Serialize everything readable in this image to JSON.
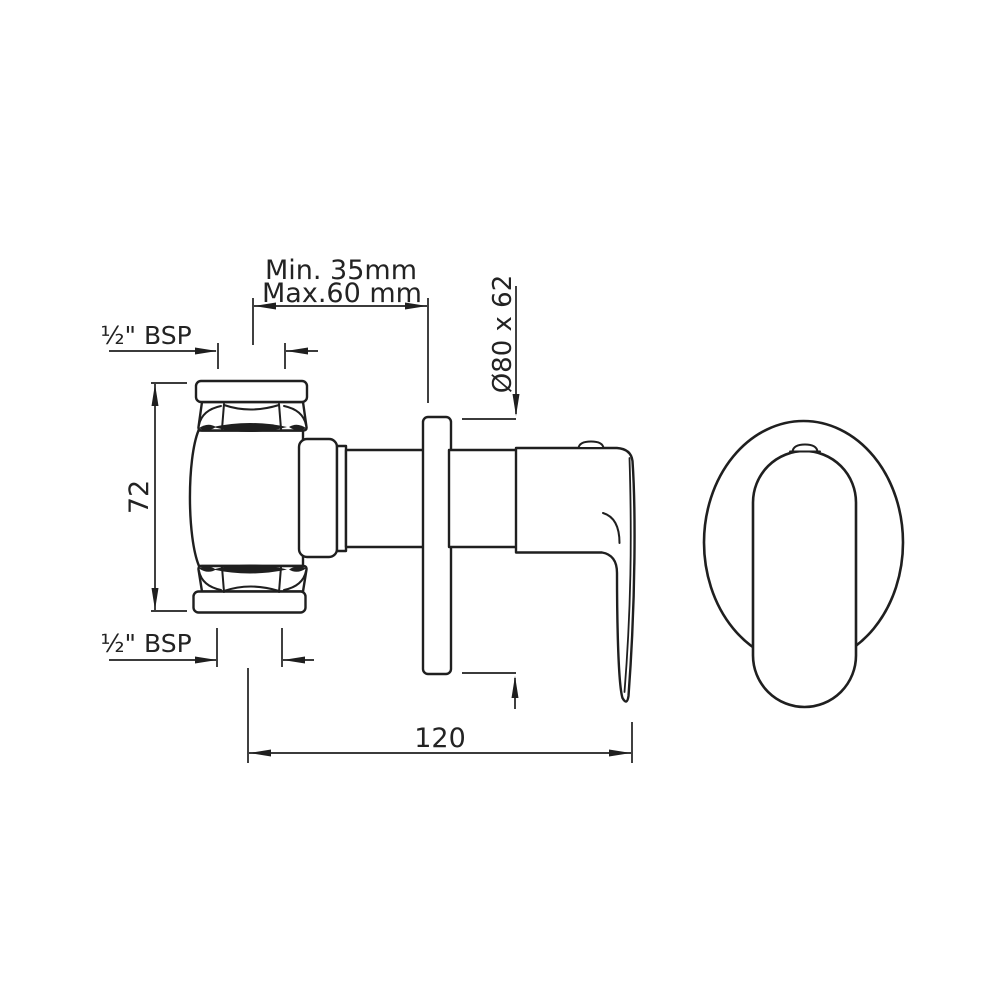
{
  "page": {
    "background_color": "#ffffff",
    "line_color": "#1f1f1f",
    "description": "Technical dimension drawing of a concealed stop valve / shower mixer with lever handle and wall flange, side elevation and front elevation"
  },
  "drawing": {
    "views": {
      "side_view": {
        "parts": [
          "inlet-cap-top",
          "hex-nut-top",
          "valve-body",
          "hex-nut-bottom",
          "inlet-cap-bottom",
          "body-shoulder",
          "spindle-ring",
          "spindle-shaft",
          "wall-flange-plate",
          "handle-body",
          "lever-blade",
          "handle-button"
        ]
      },
      "front_view": {
        "parts": [
          "escutcheon-oval",
          "lever-handle-front",
          "handle-button-front"
        ]
      }
    },
    "dimensions": [
      {
        "id": "wall-depth",
        "label_line1": "Min. 35mm",
        "label_line2": "Max.60 mm"
      },
      {
        "id": "thread-top",
        "label": "½\" BSP"
      },
      {
        "id": "thread-bottom",
        "label": "½\" BSP"
      },
      {
        "id": "body-height",
        "label": "72"
      },
      {
        "id": "flange-size",
        "label": "Ø80 x 62"
      },
      {
        "id": "overall-length",
        "label": "120"
      }
    ]
  }
}
